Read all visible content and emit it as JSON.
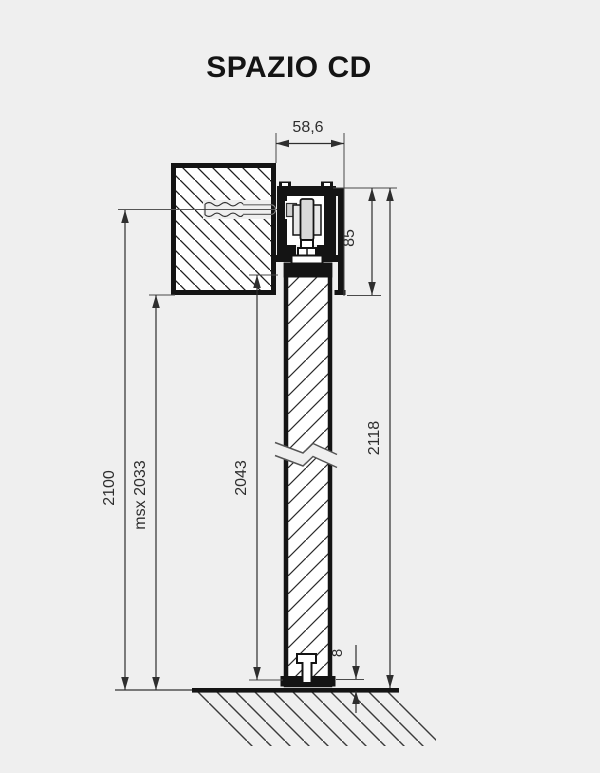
{
  "title": "SPAZIO CD",
  "drawing": {
    "colors": {
      "background": "#efefef",
      "line": "#141414",
      "dimension_line": "#2e2e2e"
    },
    "dimensions": {
      "track_depth": "58,6",
      "header_height": "85",
      "overall_height": "2118",
      "door_height": "2043",
      "max_clear_height": "msx 2033",
      "clear_height": "2100",
      "floor_gap": "8"
    }
  }
}
